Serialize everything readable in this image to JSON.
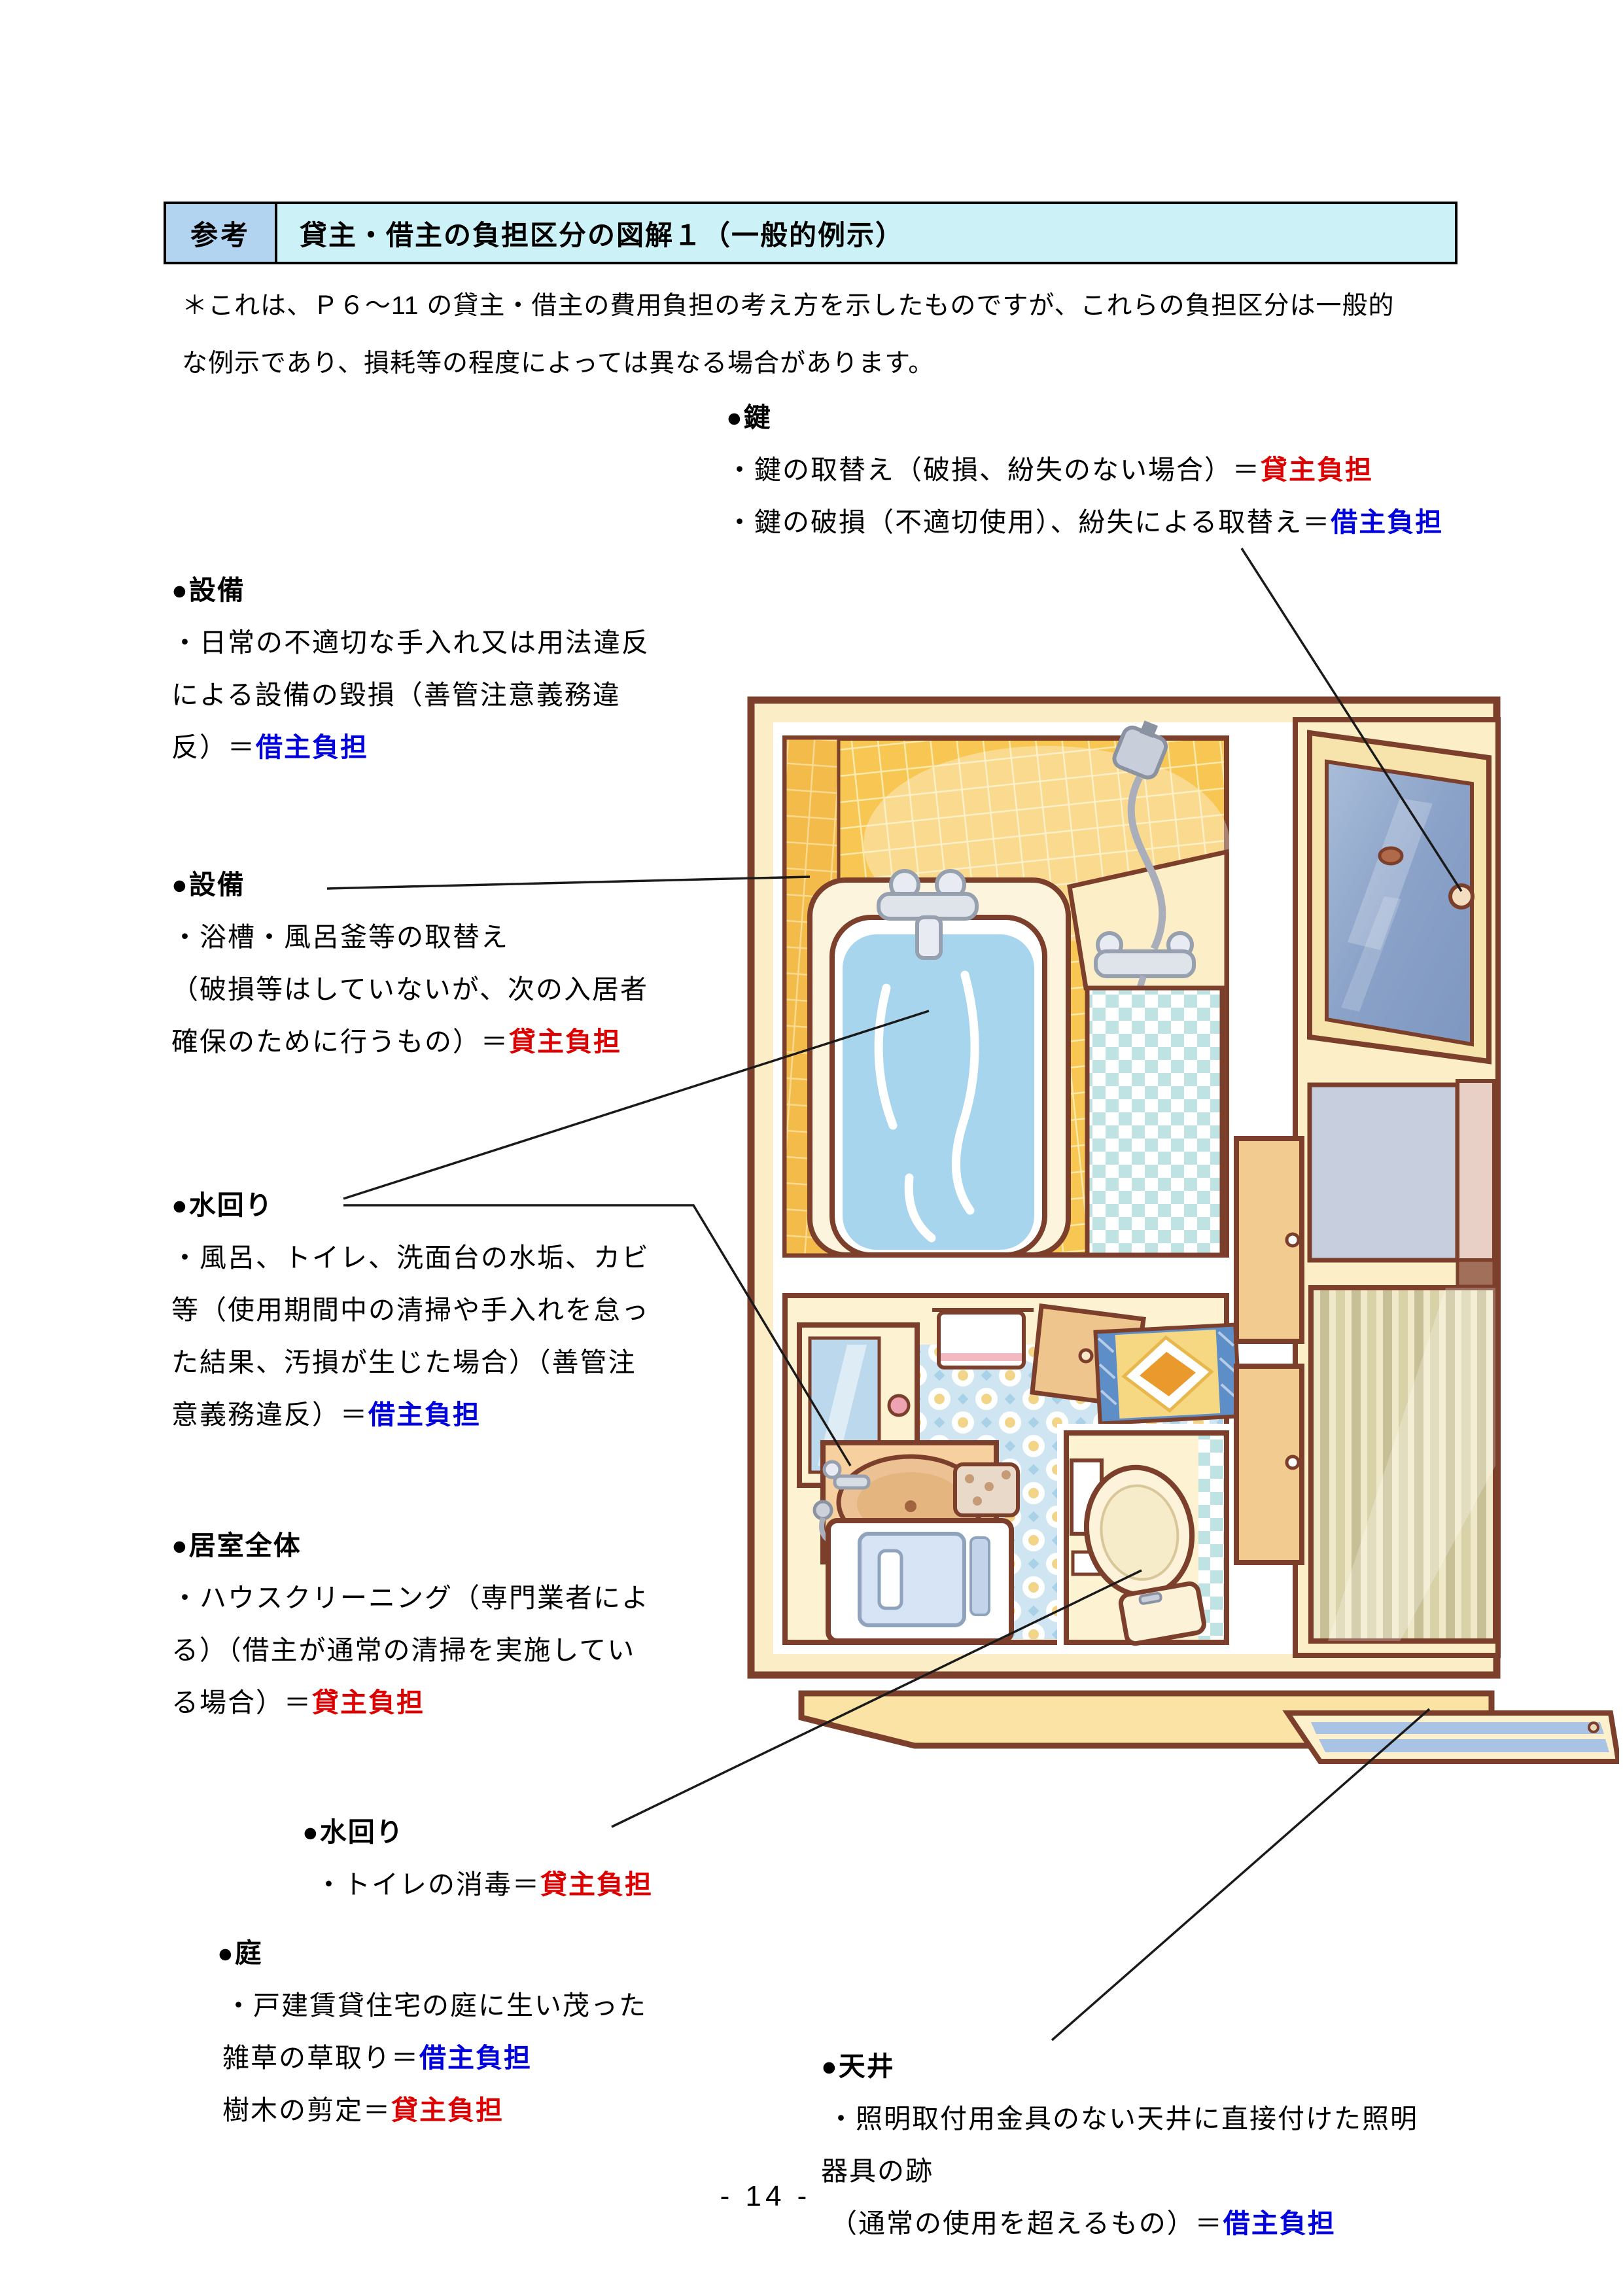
{
  "page": {
    "number": "- 14 -"
  },
  "header": {
    "tag": "参考",
    "title": "貸主・借主の負担区分の図解１（一般的例示）",
    "tag_bg": "#b3d4f0",
    "title_bg": "#ccf2f7"
  },
  "intro": {
    "line1": "＊これは、Ｐ６～11 の貸主・借主の費用負担の考え方を示したものですが、これらの負担区分は一般的",
    "line2": "な例示であり、損耗等の程度によっては異なる場合があります。"
  },
  "colors": {
    "landlord_burden": "#dd0000",
    "tenant_burden": "#0000dd",
    "outline_brown": "#7c3f2b",
    "tile_orange": "#f8c753",
    "water_blue": "#a8d5ee",
    "door_glass_blue": "#8aa2c8"
  },
  "sections": {
    "key": {
      "label": "●鍵",
      "l1pre": "・鍵の取替え（破損、紛失のない場合）＝",
      "l1burden": "貸主負担",
      "l2pre": "・鍵の破損（不適切使用）、紛失による取替え＝",
      "l2burden": "借主負担"
    },
    "equip1": {
      "label": "●設備",
      "l1": "・日常の不適切な手入れ又は用法違反",
      "l2": "による設備の毀損（善管注意義務違",
      "l3pre": "反）＝",
      "l3burden": "借主負担"
    },
    "equip2": {
      "label": "●設備",
      "l1": "・浴槽・風呂釜等の取替え",
      "l2": "（破損等はしていないが、次の入居者",
      "l3pre": "確保のために行うもの）＝",
      "l3burden": "貸主負担"
    },
    "mizu1": {
      "label": "●水回り",
      "l1": "・風呂、トイレ、洗面台の水垢、カビ",
      "l2": "等（使用期間中の清掃や手入れを怠っ",
      "l3": "た結果、汚損が生じた場合）（善管注",
      "l4pre": "意義務違反）＝",
      "l4burden": "借主負担"
    },
    "living": {
      "label": "●居室全体",
      "l1": "・ハウスクリーニング（専門業者によ",
      "l2": "る）（借主が通常の清掃を実施してい",
      "l3pre": "る場合）＝",
      "l3burden": "貸主負担"
    },
    "mizu2": {
      "label": "●水回り",
      "l1pre": "・トイレの消毒＝",
      "l1burden": "貸主負担"
    },
    "garden": {
      "label": "●庭",
      "l1": "・戸建賃貸住宅の庭に生い茂った",
      "l2pre": "雑草の草取り＝",
      "l2burden": "借主負担",
      "l3pre": "樹木の剪定＝",
      "l3burden": "貸主負担"
    },
    "ceiling": {
      "label": "●天井",
      "l1": "・照明取付用金具のない天井に直接付けた照明",
      "l2": "器具の跡",
      "l3pre": "（通常の使用を超えるもの）＝",
      "l3burden": "借主負担"
    }
  },
  "illustration": {
    "parts": [
      "entrance-door",
      "door-knob",
      "bathtub",
      "bath-water",
      "bath-faucet",
      "shower-head",
      "shower-mixer",
      "checker-wall",
      "washbasin",
      "mirror-cabinet",
      "towel-rack",
      "access-panel",
      "bath-mat",
      "washing-machine",
      "laundry-basket",
      "toilet",
      "toilet-window",
      "striped-screen",
      "cabinet-doors",
      "entrance-floor",
      "sliding-door-rail"
    ]
  }
}
